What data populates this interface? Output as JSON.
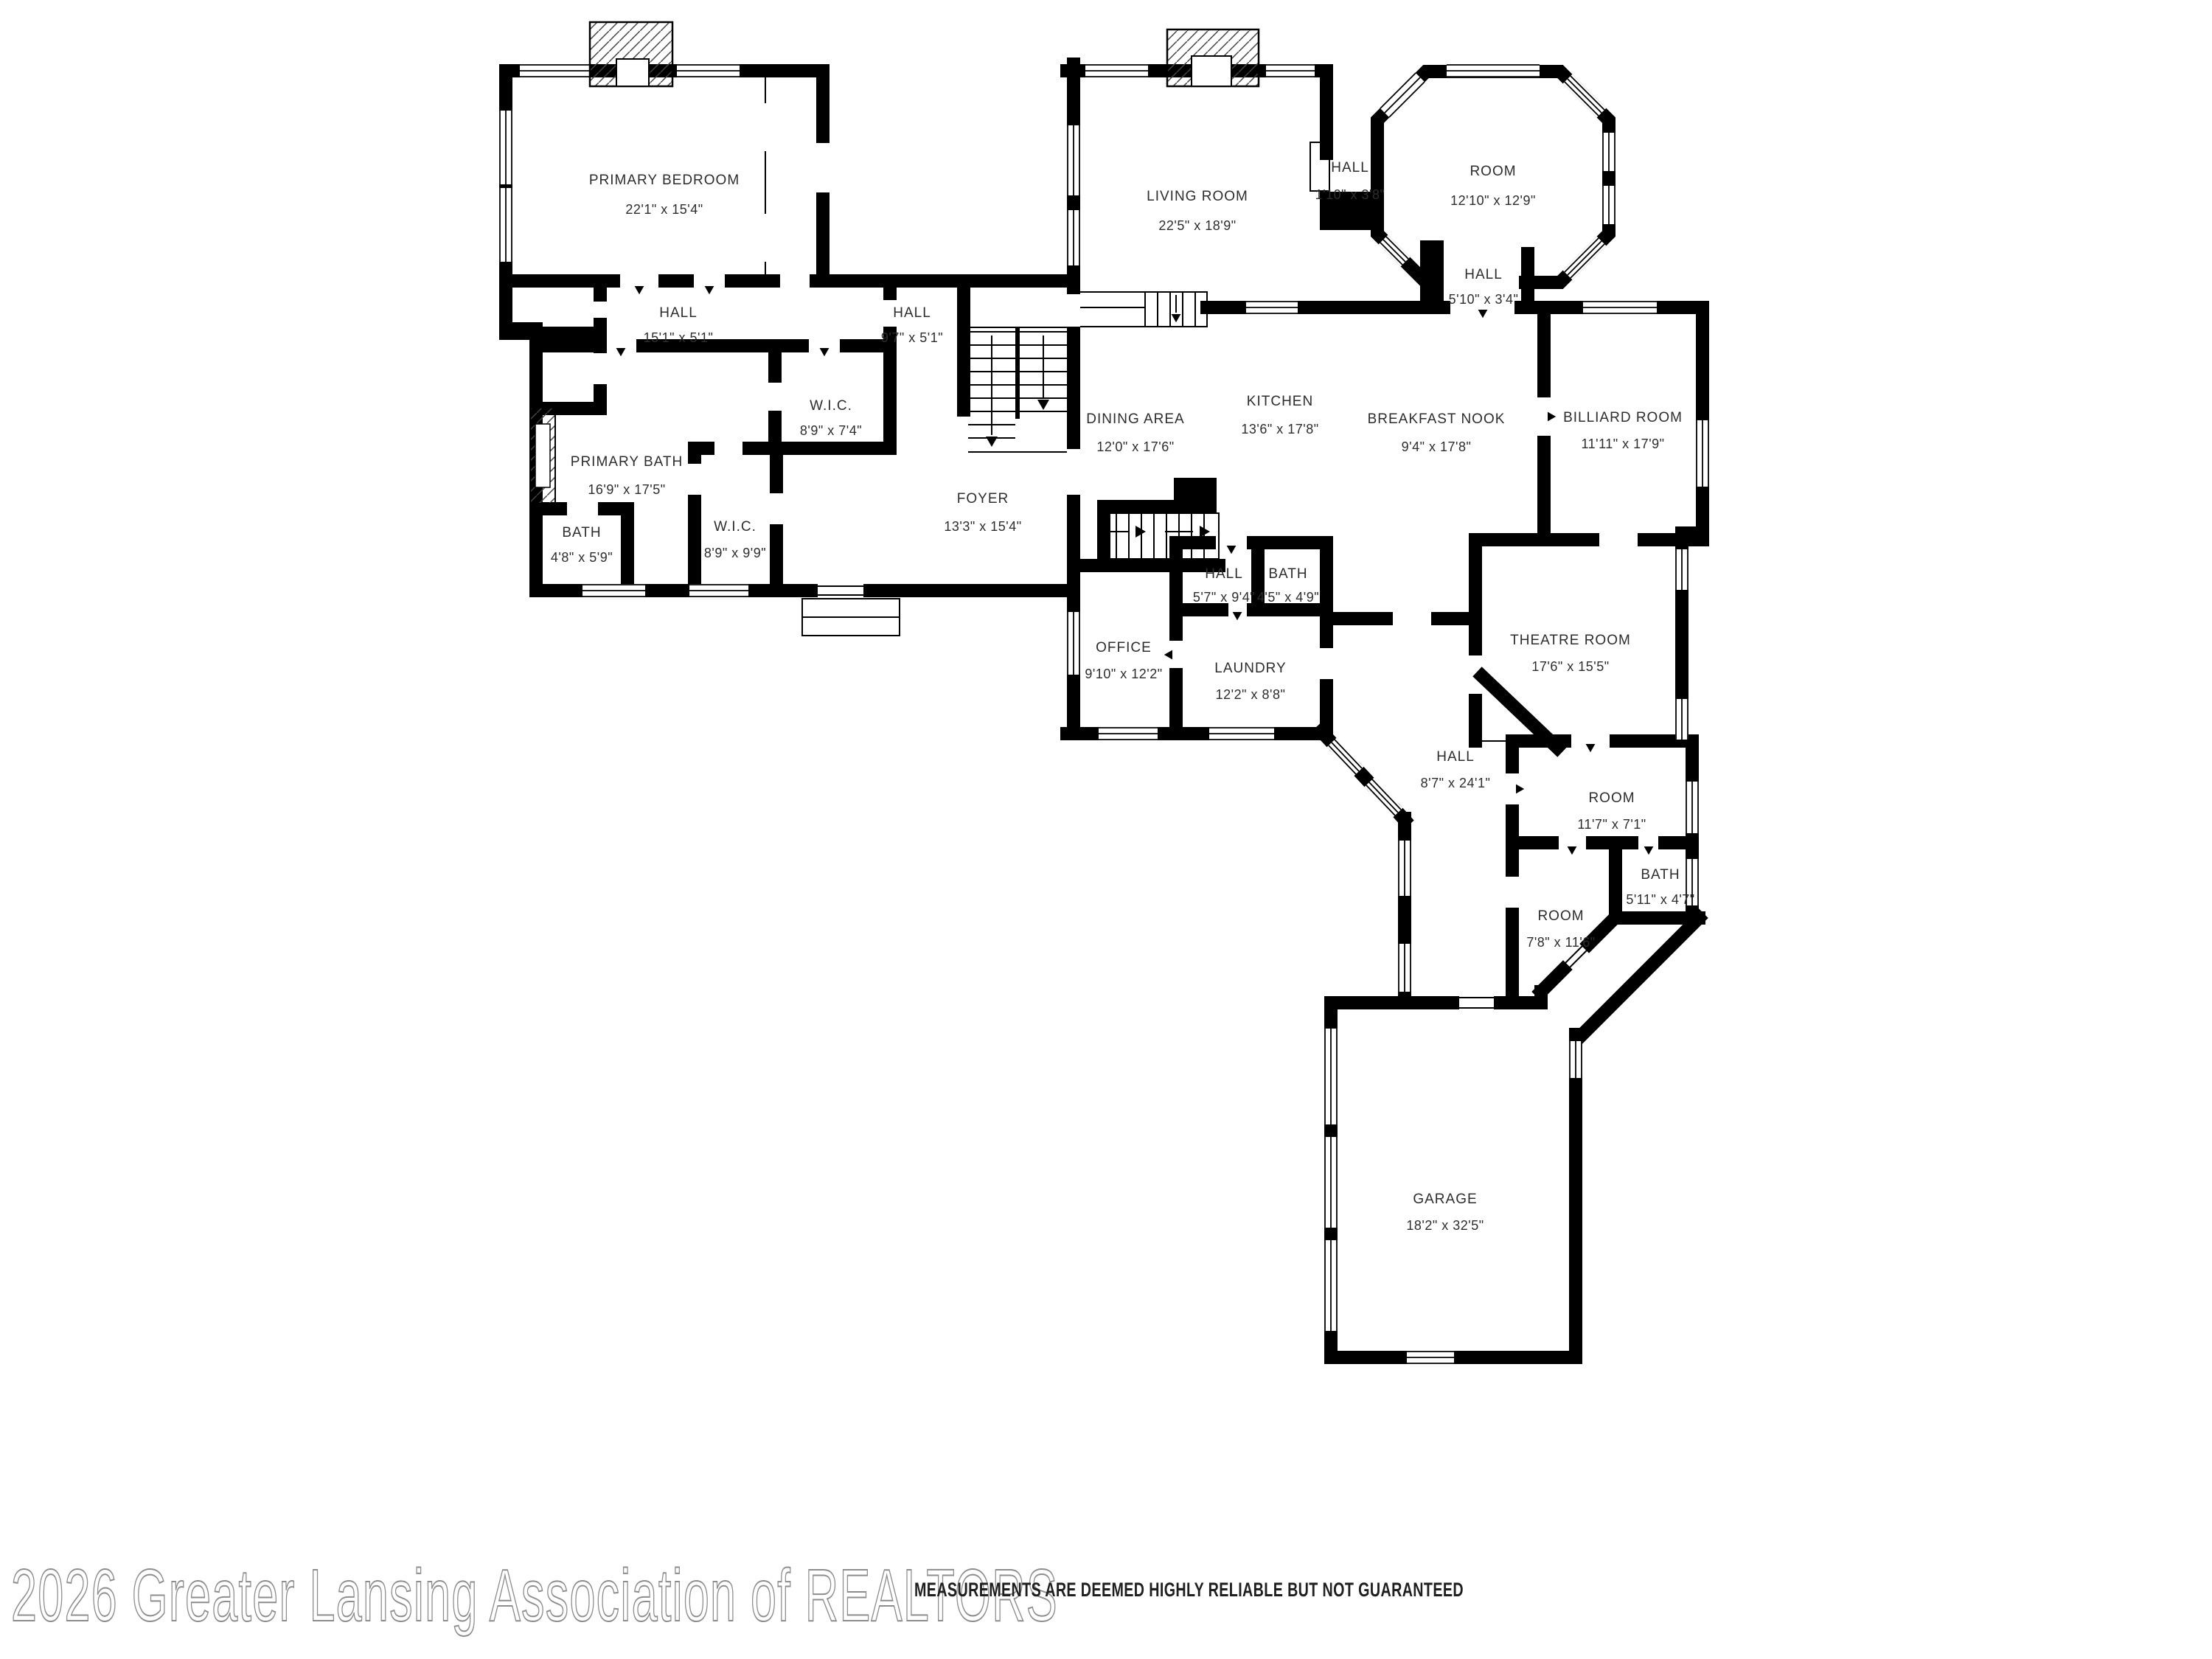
{
  "footer": {
    "watermark": "2026 Greater Lansing Association of REALTORS",
    "disclaimer": "MEASUREMENTS ARE DEEMED HIGHLY RELIABLE BUT NOT GUARANTEED"
  },
  "colors": {
    "walls": "#000000",
    "background": "#ffffff",
    "label_text": "#2d2d2d",
    "watermark_outline": "#8d8d8d"
  },
  "rooms": [
    {
      "name": "PRIMARY BEDROOM",
      "dims": "22'1\" x 15'4\""
    },
    {
      "name": "LIVING ROOM",
      "dims": "22'5\" x 18'9\""
    },
    {
      "name": "ROOM",
      "dims": "12'10\" x 12'9\""
    },
    {
      "name": "HALL",
      "dims": "1'10\" x 3'8\""
    },
    {
      "name": "HALL",
      "dims": "5'10\" x 3'4\""
    },
    {
      "name": "HALL",
      "dims": "15'1\" x 5'1\""
    },
    {
      "name": "HALL",
      "dims": "9'7\" x 5'1\""
    },
    {
      "name": "W.I.C.",
      "dims": "8'9\" x 7'4\""
    },
    {
      "name": "PRIMARY BATH",
      "dims": "16'9\" x 17'5\""
    },
    {
      "name": "BATH",
      "dims": "4'8\" x 5'9\""
    },
    {
      "name": "W.I.C.",
      "dims": "8'9\" x 9'9\""
    },
    {
      "name": "FOYER",
      "dims": "13'3\" x 15'4\""
    },
    {
      "name": "DINING AREA",
      "dims": "12'0\" x 17'6\""
    },
    {
      "name": "KITCHEN",
      "dims": "13'6\" x 17'8\""
    },
    {
      "name": "BREAKFAST NOOK",
      "dims": "9'4\" x 17'8\""
    },
    {
      "name": "BILLIARD ROOM",
      "dims": "11'11\" x 17'9\""
    },
    {
      "name": "HALL",
      "dims": "5'7\" x 9'4\""
    },
    {
      "name": "BATH",
      "dims": "4'5\" x 4'9\""
    },
    {
      "name": "OFFICE",
      "dims": "9'10\" x 12'2\""
    },
    {
      "name": "LAUNDRY",
      "dims": "12'2\" x 8'8\""
    },
    {
      "name": "THEATRE ROOM",
      "dims": "17'6\" x 15'5\""
    },
    {
      "name": "HALL",
      "dims": "8'7\" x 24'1\""
    },
    {
      "name": "ROOM",
      "dims": "11'7\" x 7'1\""
    },
    {
      "name": "BATH",
      "dims": "5'11\" x 4'7\""
    },
    {
      "name": "ROOM",
      "dims": "7'8\" x 11'6\""
    },
    {
      "name": "GARAGE",
      "dims": "18'2\" x 32'5\""
    }
  ]
}
